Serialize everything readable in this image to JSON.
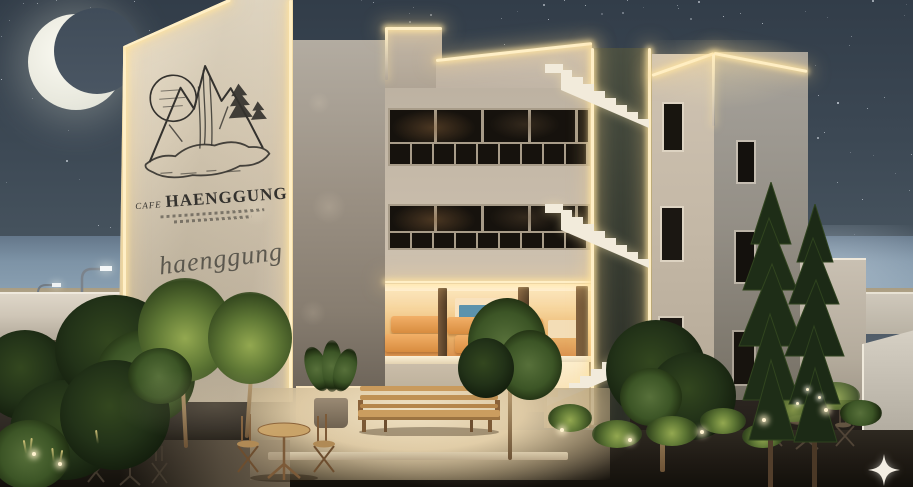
{
  "scene": {
    "type": "architectural-night-render",
    "subject": "Cafe Haenggung building exterior at night",
    "setting": "seaside courtyard, crescent moon, starry sky, LED edge-lit facades"
  },
  "logo": {
    "prefix": "CAFE",
    "name": "HAENGGUNG",
    "signature": "haenggung",
    "artwork": "mountain-waterfall-pines-sketch"
  },
  "icons": {
    "moon": "crescent-moon",
    "watermark": "four-point-sparkle"
  },
  "palette": {
    "sky_top": "#323d49",
    "sky_horizon": "#5d6a76",
    "sea": "#8aa0b2",
    "beach": "#b7aa8e",
    "wall_lit": "#f1e7d2",
    "wall_base": "#cfc3ad",
    "led_glow": "#ffeebf",
    "interior_glow": "#f6d49b",
    "bench_orange": "#e29b4e",
    "stair_recess": "#3c4136",
    "foliage_dark": "#24361d",
    "foliage_lit": "#7f9b4e",
    "night_ground": "#1c1712"
  }
}
